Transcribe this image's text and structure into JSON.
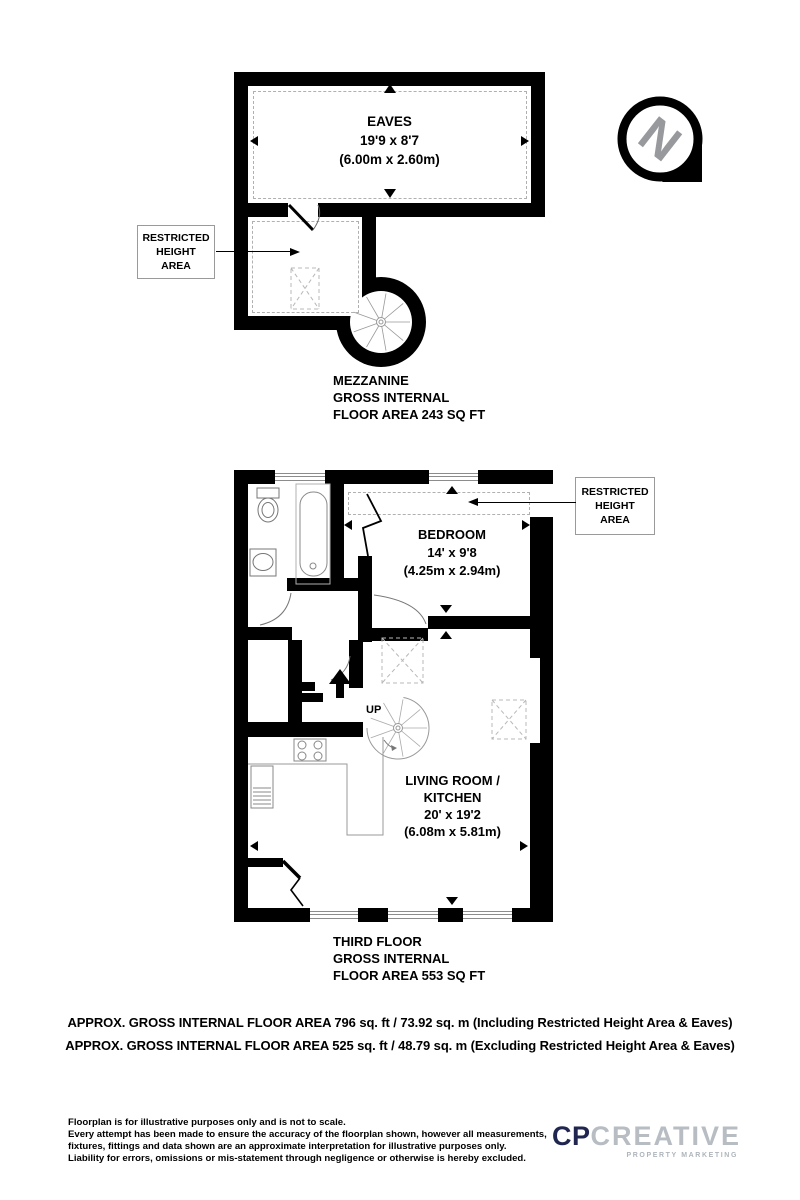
{
  "compass": {
    "letter": "N"
  },
  "mezzanine": {
    "eaves": {
      "name": "EAVES",
      "dims_imperial": "19'9 x 8'7",
      "dims_metric": "(6.00m x 2.60m)"
    },
    "restricted_label_lines": [
      "RESTRICTED",
      "HEIGHT",
      "AREA"
    ],
    "caption_lines": [
      "MEZZANINE",
      "GROSS INTERNAL",
      "FLOOR AREA 243 SQ FT"
    ]
  },
  "third_floor": {
    "bedroom": {
      "name": "BEDROOM",
      "dims_imperial": "14' x 9'8",
      "dims_metric": "(4.25m x 2.94m)"
    },
    "living_kitchen": {
      "name_line1": "LIVING ROOM /",
      "name_line2": "KITCHEN",
      "dims_imperial": "20' x 19'2",
      "dims_metric": "(6.08m x 5.81m)"
    },
    "stair_up_label": "UP",
    "restricted_label_lines": [
      "RESTRICTED",
      "HEIGHT",
      "AREA"
    ],
    "caption_lines": [
      "THIRD FLOOR",
      "GROSS INTERNAL",
      "FLOOR AREA 553 SQ FT"
    ]
  },
  "summary": {
    "line1": "APPROX. GROSS INTERNAL FLOOR AREA 796 sq. ft / 73.92 sq. m (Including Restricted Height Area & Eaves)",
    "line2": "APPROX. GROSS INTERNAL FLOOR AREA 525 sq. ft / 48.79 sq. m (Excluding Restricted Height Area & Eaves)"
  },
  "footer": {
    "disclaimer_lines": [
      "Floorplan is for illustrative purposes only and is not to scale.",
      "Every attempt has been made to ensure the accuracy of the floorplan shown, however all measurements,",
      "fixtures, fittings and data shown are an approximate interpretation for illustrative purposes only.",
      "Liability for errors, omissions or mis-statement through negligence or otherwise is hereby excluded."
    ],
    "logo": {
      "prefix": "CP",
      "name": "CREATIVE",
      "tagline": "PROPERTY MARKETING"
    }
  },
  "colors": {
    "wall": "#000000",
    "logo_navy": "#20264f",
    "logo_gray": "#b7bdc3",
    "compass_gray": "#97999c",
    "dash_gray": "#b0b0b0"
  }
}
